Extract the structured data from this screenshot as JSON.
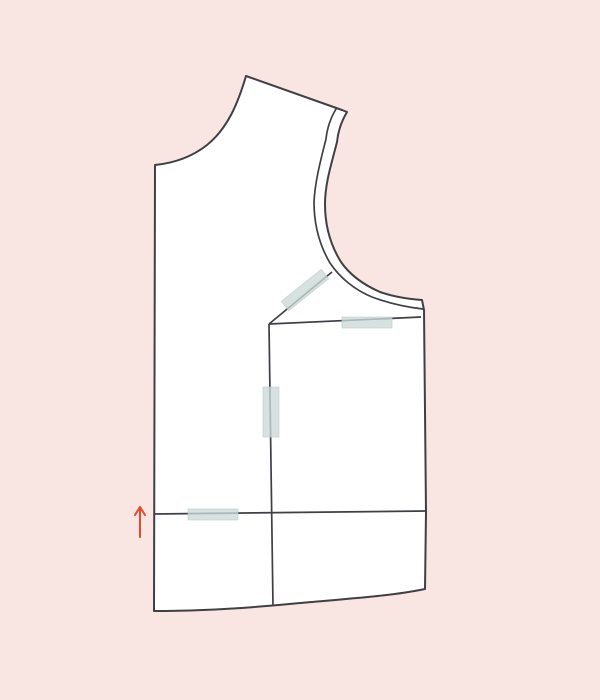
{
  "scene": {
    "description": "Sewing pattern alteration illustration: a bodice pattern piece cut apart, sections overlapped and held with pieces of tape, with a red arrow indicating the upward (shortening) direction",
    "text_content": ""
  },
  "colors": {
    "background": "#f9e6e3",
    "paper": "#ffffff",
    "outline": "#3f3f45",
    "tape_fill": "#cbd9d7",
    "tape_edge": "#b7ccc9",
    "arrow": "#e2492f"
  },
  "paths": {
    "background": "M0,0 H600 V700 H0 Z",
    "silhouette": "M246,76 L342,110 L347,112 C341,122 338,132 337,142 C332,162 325,183 325,204 C325,227 331,246 341,262 C350,275 364,285 380,292 C394,297 408,299 422,300 L424,310 L426,512 L425,589 C392,596 345,599 300,603 C250,608 200,611 154,611 L155,165 C175,163 193,156 207,145 C228,128 238,103 246,76 Z",
    "armhole_inner": "M336,109 C330,119 327,129 326,139 C321,159 315,181 314,202 C314,226 320,246 330,263 C340,278 355,290 372,297 C388,303 405,307 423,309",
    "diagonal_cut": "M269,324 L332,272",
    "panel_top_edge": "M269,324 L421,317",
    "vertical_cut": "M269,324 L273,606",
    "horizontal_cut": "M154,514 L426,511",
    "tape_diagonal": "M288.7,310.7 L328.7,278.7 L321.3,269.3 L281.3,301.3 Z",
    "tape_top": "M342,317 L392,317 L392,328 L342,328 Z",
    "tape_middle": "M263,387 L279,387 L279,437 L263,437 Z",
    "tape_bottom": "M188,509 L238,509 L238,520 L188,520 Z",
    "arrow_shaft": "M140,537 L140,508",
    "arrow_head": "M135,515 L140,507 L145,515"
  }
}
